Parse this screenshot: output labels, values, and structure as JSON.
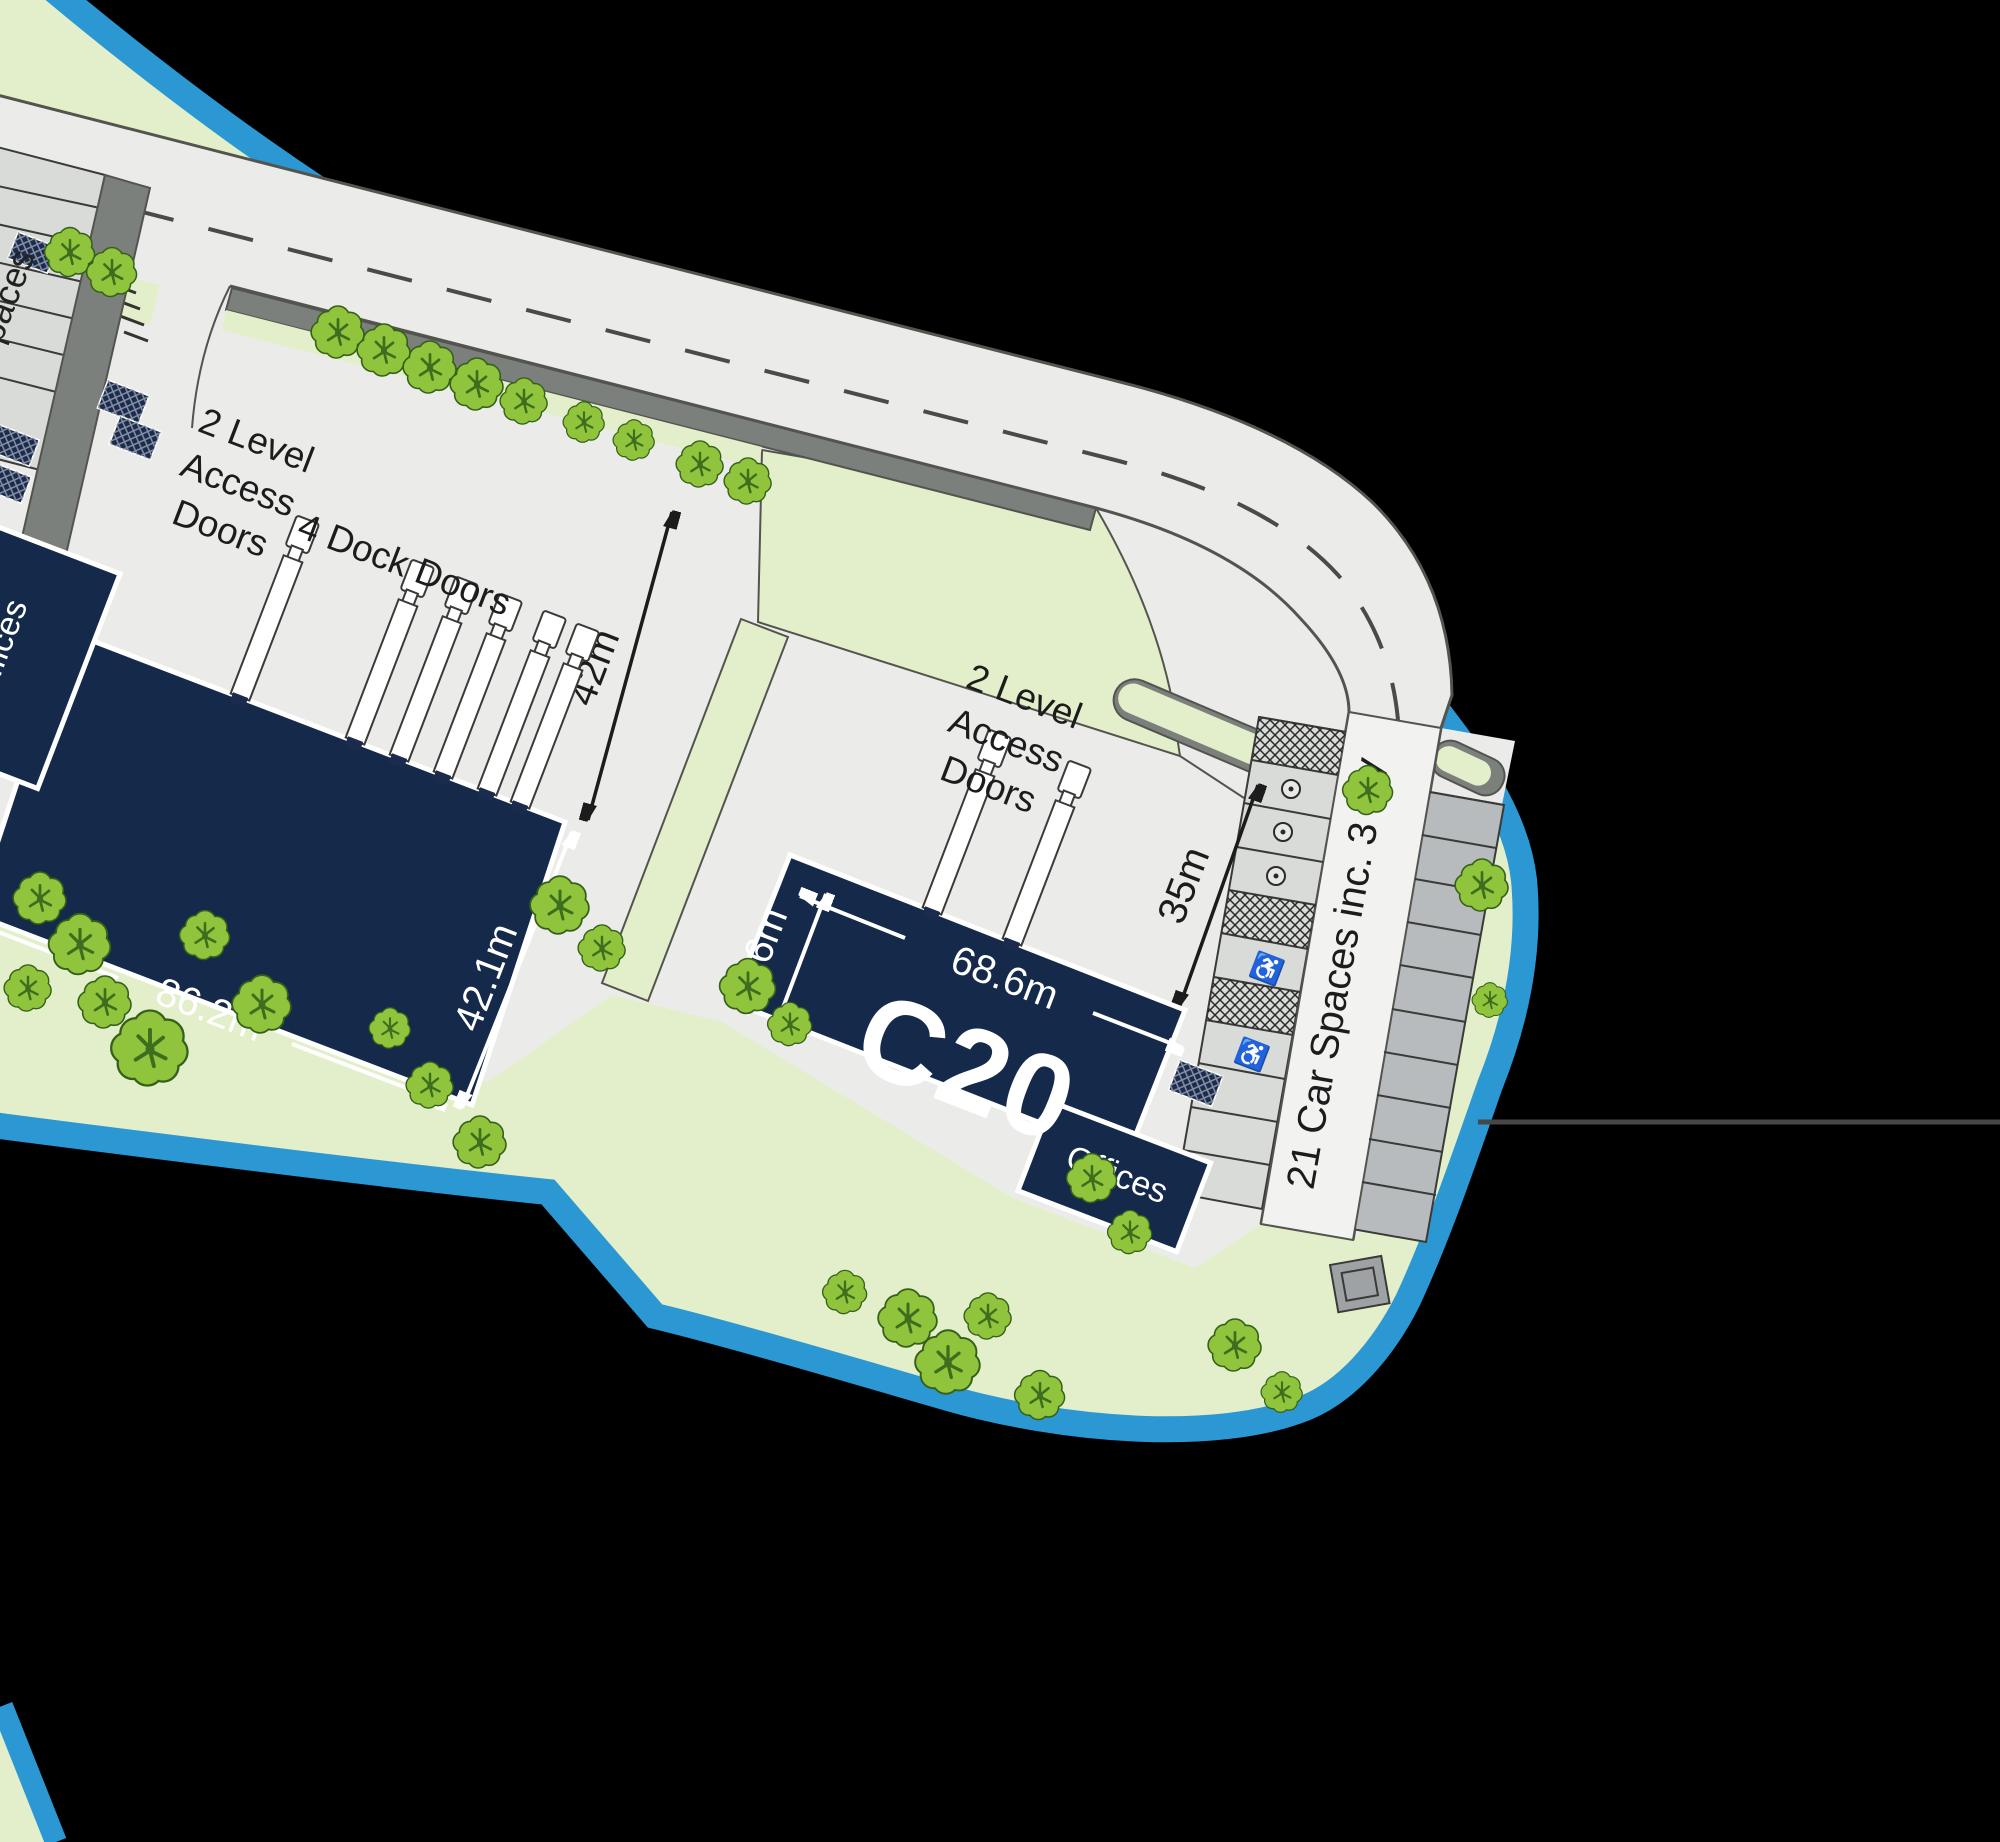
{
  "title": "Industrial estate site plan",
  "colors": {
    "background": "#000000",
    "landscaping_green": "#e3efca",
    "tree_green": "#8fc43c",
    "pavement_grey": "#ebecea",
    "verge_grey": "#7c807c",
    "building_navy": "#15294b",
    "boundary_blue": "#2b97d3",
    "dimension_white": "#ffffff",
    "dimension_black": "#1c1c1c"
  },
  "plan": {
    "building_left": {
      "offices_label": "Offices",
      "width_dim": "86.2m",
      "depth_dim": "42.1m",
      "yard_depth_dim": "42m",
      "level_access_lines": [
        "2 Level",
        "Access",
        "Doors"
      ],
      "dock_doors_label": "4 Dock Doors"
    },
    "building_c20": {
      "name": "C20",
      "offices_label": "Offices",
      "width_dim": "68.6m",
      "depth_dim": "25.6m",
      "yard_depth_dim": "35m",
      "level_access_lines": [
        "2 Level",
        "Access",
        "Doors"
      ]
    },
    "parking": {
      "label": "21 Car Spaces inc. 3 EV",
      "left_edge_fragment": "paces"
    },
    "icons": {
      "disabled": "♿"
    }
  }
}
